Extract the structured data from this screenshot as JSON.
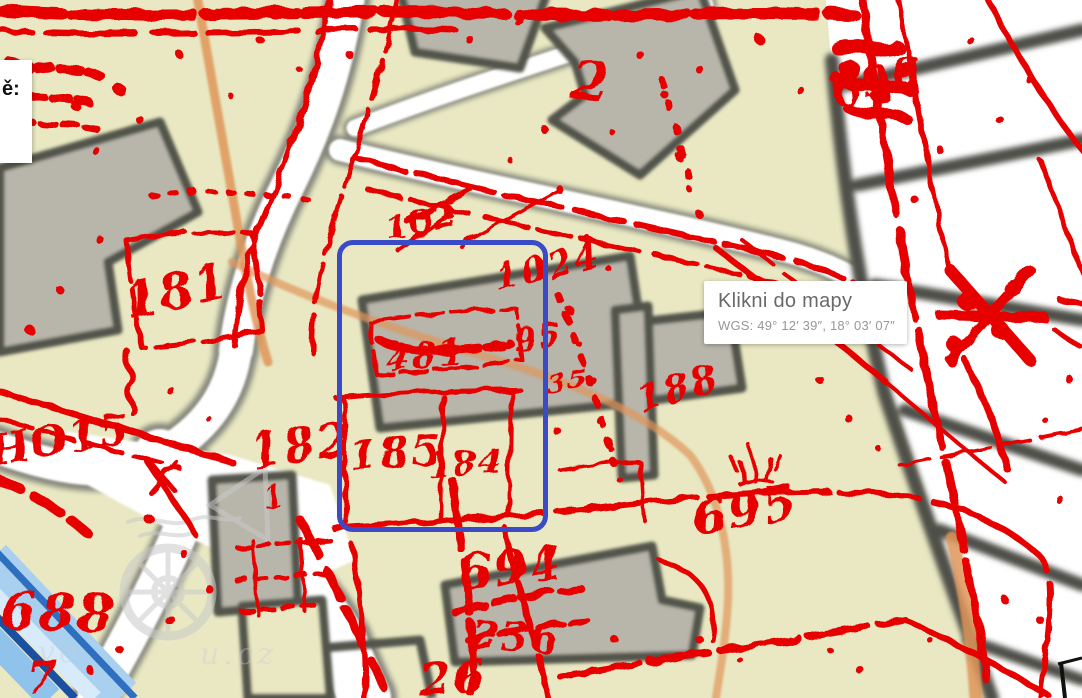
{
  "panel": {
    "text": "ě:"
  },
  "tooltip": {
    "title": "Klikni do mapy",
    "wgs": "WGS: 49° 12′ 39″, 18° 03′ 07″"
  },
  "selection": {
    "shape": "rounded-rectangle",
    "color": "#3a4bc5"
  },
  "map": {
    "overlay_color": "#e60000",
    "base_colors": {
      "land": "#e9e8c2",
      "road": "#ffffff",
      "building_fill": "#b8b5aa",
      "building_outline": "#53544c",
      "path_orange": "#df9559",
      "water_light": "#a9d0ef",
      "water_dark": "#1b4fa0"
    },
    "parcel_labels": [
      {
        "text": "181"
      },
      {
        "text": "182"
      },
      {
        "text": "185"
      },
      {
        "text": "184"
      },
      {
        "text": "481"
      },
      {
        "text": "95"
      },
      {
        "text": "35"
      },
      {
        "text": "1024"
      },
      {
        "text": "102"
      },
      {
        "text": "188"
      },
      {
        "text": "695"
      },
      {
        "text": "694"
      },
      {
        "text": "2"
      },
      {
        "text": "690"
      },
      {
        "text": "688"
      },
      {
        "text": "7"
      },
      {
        "text": "HO15"
      },
      {
        "text": "236"
      },
      {
        "text": "26"
      },
      {
        "text": "1"
      }
    ],
    "watermark": {
      "fragments": [
        "vo",
        "u.cz"
      ]
    }
  }
}
